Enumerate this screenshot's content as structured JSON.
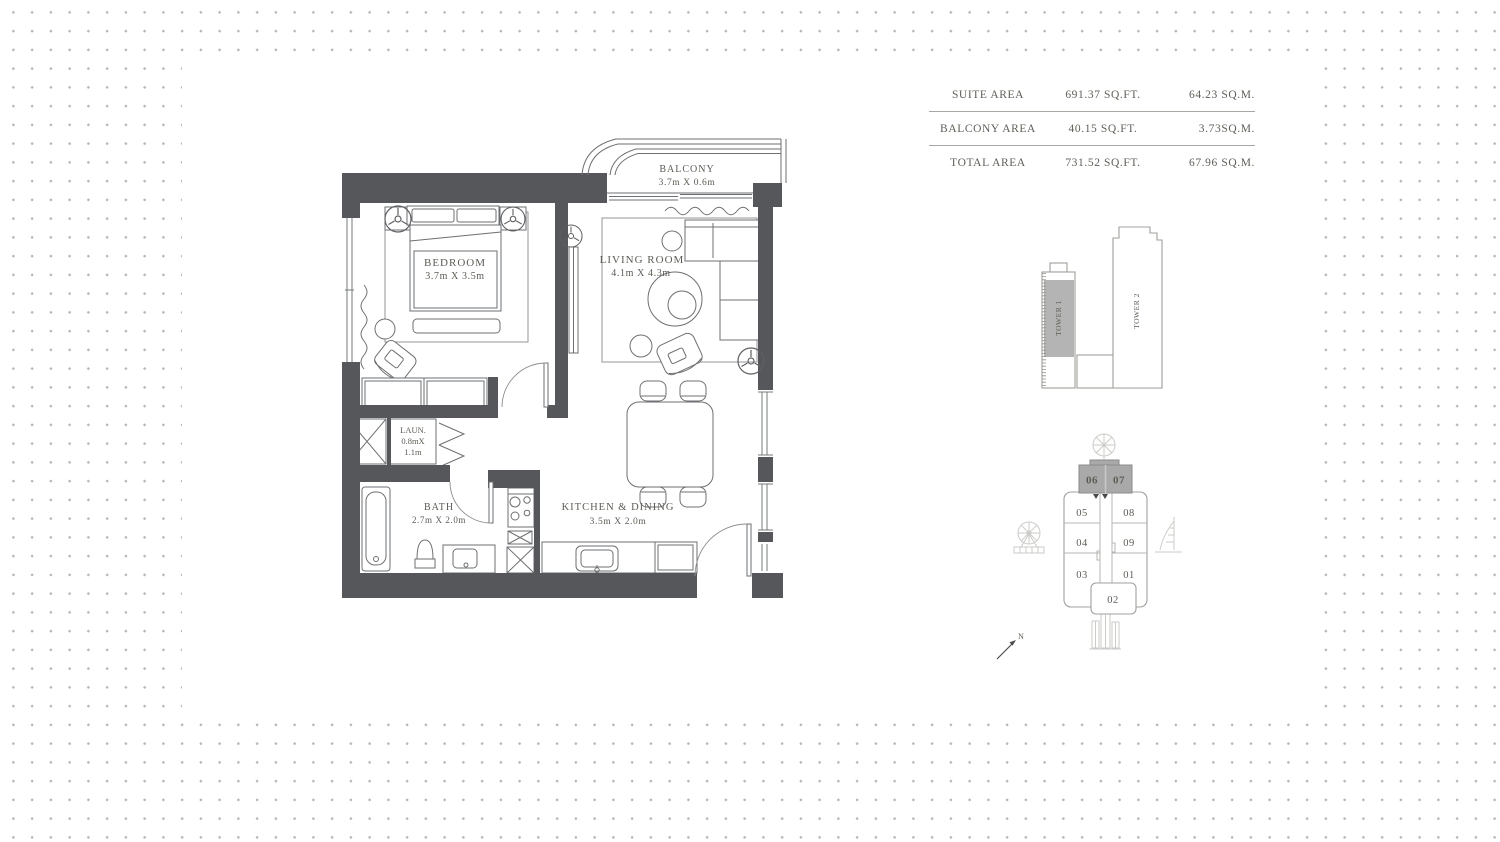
{
  "area_table": {
    "rows": [
      {
        "label": "SUITE AREA",
        "sqft": "691.37 SQ.FT.",
        "sqm": "64.23 SQ.M."
      },
      {
        "label": "BALCONY AREA",
        "sqft": "40.15 SQ.FT.",
        "sqm": "3.73SQ.M."
      },
      {
        "label": "TOTAL AREA",
        "sqft": "731.52 SQ.FT.",
        "sqm": "67.96 SQ.M."
      }
    ]
  },
  "floor_plan": {
    "balcony": {
      "name": "BALCONY",
      "dims": "3.7m X 0.6m"
    },
    "bedroom": {
      "name": "BEDROOM",
      "dims": "3.7m X 3.5m"
    },
    "living_room": {
      "name": "LIVING ROOM",
      "dims": "4.1m X 4.3m"
    },
    "laundry": {
      "name": "LAUN.",
      "dims_line1": "0.8mX",
      "dims_line2": "1.1m"
    },
    "bath": {
      "name": "BATH",
      "dims": "2.7m X 2.0m"
    },
    "kitchen_dining": {
      "name": "KITCHEN & DINING",
      "dims": "3.5m X 2.0m"
    }
  },
  "towers": {
    "tower1_label": "TOWER 1",
    "tower2_label": "TOWER 2"
  },
  "key_plan": {
    "highlighted_units": [
      "06",
      "07"
    ],
    "left_units": [
      "05",
      "04",
      "03"
    ],
    "right_units": [
      "08",
      "09",
      "01"
    ],
    "bottom_unit": "02",
    "north_label": "N",
    "landmark_icons": [
      "palm-tree-icon",
      "ferris-wheel-icon",
      "burj-al-arab-icon",
      "skyline-icon"
    ]
  },
  "colors": {
    "wall": "#56575A",
    "plan_line": "#6E6F72",
    "label_text": "#5B5C54",
    "highlight_unit_fill": "#A9A9A9",
    "tower_fill": "#B4B4B4",
    "background_dot": "#B5B5B5"
  }
}
